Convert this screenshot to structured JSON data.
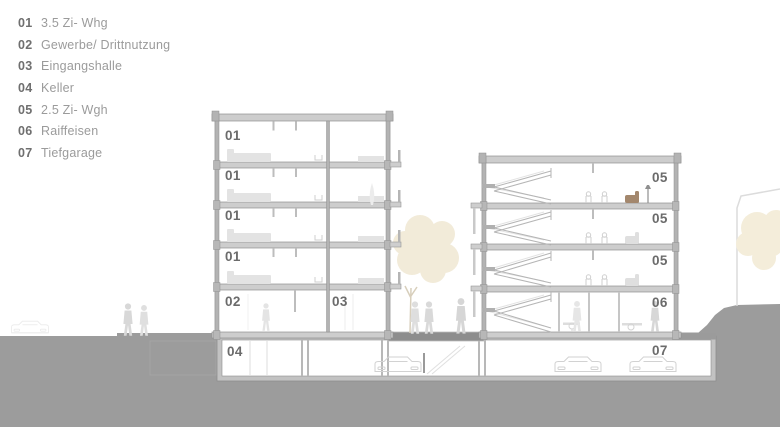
{
  "legend": {
    "items": [
      {
        "num": "01",
        "label": "3.5 Zi- Whg"
      },
      {
        "num": "02",
        "label": "Gewerbe/ Drittnutzung"
      },
      {
        "num": "03",
        "label": "Eingangshalle"
      },
      {
        "num": "04",
        "label": "Keller"
      },
      {
        "num": "05",
        "label": "2.5 Zi- Wgh"
      },
      {
        "num": "06",
        "label": "Raiffeisen"
      },
      {
        "num": "07",
        "label": "Tiefgarage"
      }
    ]
  },
  "section": {
    "floor_labels": {
      "f01": "01",
      "f02": "02",
      "f03": "03",
      "f04": "04",
      "f05": "05",
      "f06": "06",
      "f07": "07"
    }
  },
  "colors": {
    "background": "#ffffff",
    "terrain": "#9c9c9c",
    "ground_band": "#8d8d8d",
    "wall": "#b3b3b3",
    "slab": "#cdcdcd",
    "outline": "#8f8f8f",
    "floor_label": "#6b6b6b",
    "legend_number": "#6f6f6f",
    "legend_text": "#9b9b9b",
    "tree": "#f2ebd9",
    "tree_background": "#f4edda",
    "silhouette": "#d9d9d9",
    "furniture": "#e3e3e3",
    "armchair_accent": "#a3876d"
  }
}
